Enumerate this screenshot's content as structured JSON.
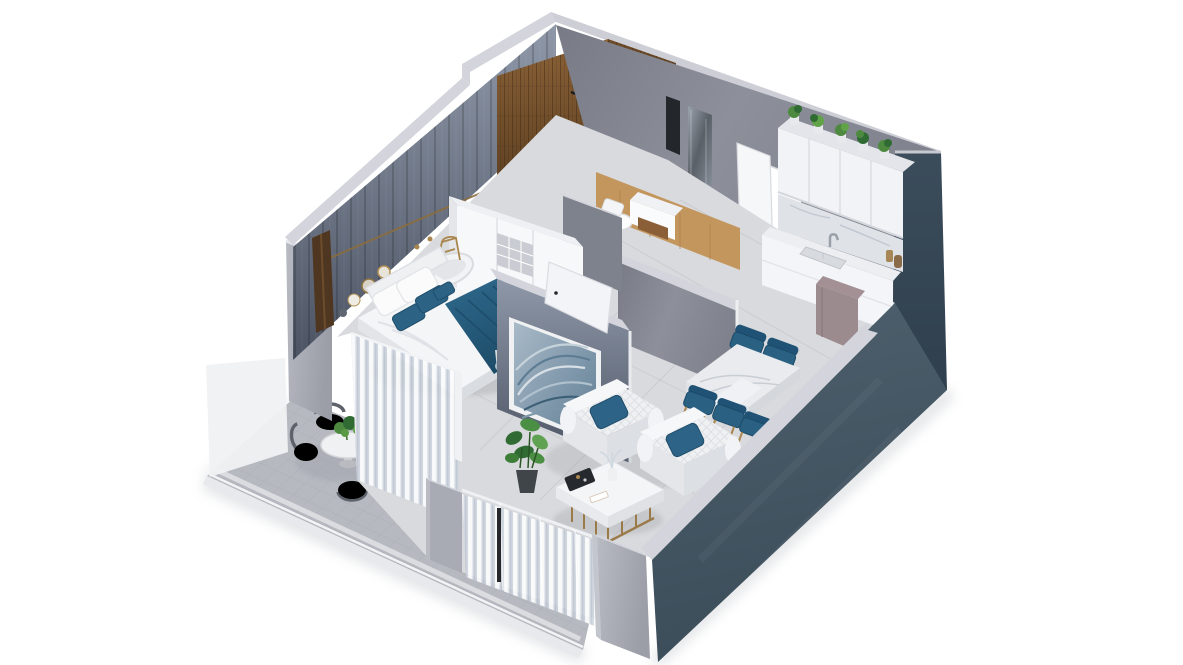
{
  "view": {
    "description": "3D isometric cutaway rendering of a one-bedroom apartment floor plan with bedroom, bathroom with wood shower wall, entry hall, kitchen, living-dining area and corner balcony",
    "projection": "isometric cutaway, walls cropped, white background"
  },
  "palette": {
    "bg": "#ffffff",
    "wall-rim": "#d4d5dc",
    "concrete-light": "#b5b7c0",
    "concrete-mid": "#a0a2ac",
    "concrete-dark": "#8b8d97",
    "back-wall": "#86ismiss8995",
    "panel-wall": "#5d6677",
    "dark-wall": "#47586614",
    "accent-blue": "#2c6284",
    "accent-blue-dark": "#1f4e6b",
    "wood-wall": "#74512f",
    "wood-floor": "#c3965e",
    "floor-main": "#d9dadd",
    "balcony-tile": "#b6b9c0",
    "tile-line": "#a4a7af",
    "frosted-screen": "#f0f1f2",
    "furniture-white": "#f5f6f8",
    "furniture-white-dim": "#e3e5e9",
    "marble": "#e9ebee",
    "gold": "#a9864e",
    "mauve": "#9b8a8e",
    "plant-green": "#4d8a40",
    "plant-green-dark": "#2f6b33",
    "fixture-black": "#25272b",
    "patio-chair-grey": "#7579822",
    "curtain": "#d5dbe3",
    "sofa-white": "#eef0f2",
    "art-blue": "#879cb0"
  },
  "rooms": {
    "bedroom": {
      "items": [
        "double-bed",
        "blue-throw",
        "white-pillows",
        "blue-pillows",
        "panel-feature-wall",
        "wall-discs",
        "oval-side-table",
        "gold-stand",
        "foot-bench",
        "wardrobe",
        "sheer-curtains"
      ]
    },
    "bathroom": {
      "items": [
        "wood-shower-wall",
        "black-shower-head",
        "toilet",
        "vanity",
        "mirror-niche",
        "wood-floor"
      ]
    },
    "entry": {
      "items": [
        "open-white-door",
        "door-opening",
        "wall-niche",
        "light-switch"
      ]
    },
    "kitchen": {
      "items": [
        "upper-cabinets",
        "plant-pots-row",
        "marble-backsplash",
        "sink-counter",
        "faucet",
        "bottles",
        "mauve-fridge"
      ]
    },
    "living": {
      "items": [
        "quilted-sofa-1",
        "quilted-sofa-2",
        "blue-cushions",
        "coffee-table",
        "decor-tray",
        "vase",
        "monstera-plant",
        "sheer-curtain-wall",
        "black-floor-pole"
      ]
    },
    "dining": {
      "items": [
        "marble-table",
        "blue-dining-chairs",
        "blue-gold-bar-stools"
      ]
    },
    "balcony": {
      "items": [
        "tiled-floor",
        "frosted-privacy-screen",
        "round-table",
        "table-plant",
        "patio-chairs"
      ]
    },
    "shell": {
      "items": [
        "concrete-walls",
        "dark-slate-front-wall",
        "dark-slate-right-wall",
        "divider-wall",
        "wave-artwork",
        "bedroom-door",
        "corner-wall"
      ]
    }
  }
}
